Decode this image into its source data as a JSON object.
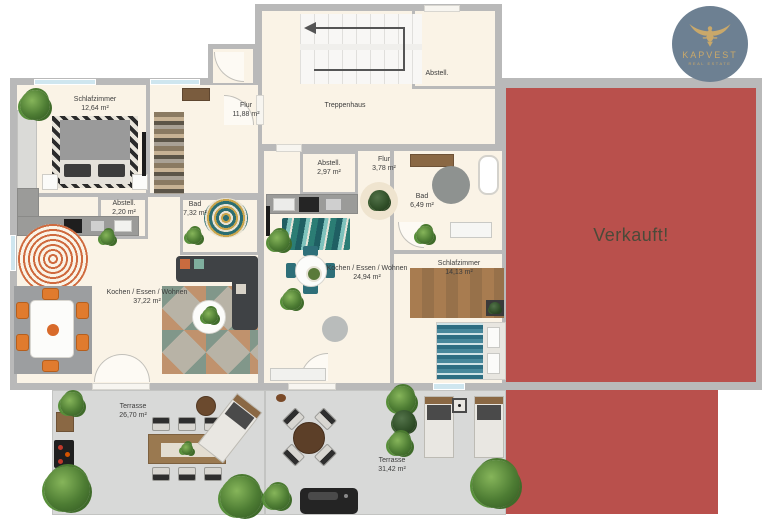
{
  "logo": {
    "brand": "KAPVEST",
    "tagline": "REAL ESTATE"
  },
  "sold": {
    "label": "Verkauft!"
  },
  "shared": {
    "treppenhaus_label": "Treppenhaus",
    "stair_storage": {
      "name": "Abstell."
    }
  },
  "apartments": {
    "left": {
      "rooms": {
        "schlafzimmer": {
          "name": "Schlafzimmer",
          "area": "12,64 m²"
        },
        "flur": {
          "name": "Flur",
          "area": "11,88 m²"
        },
        "abstell": {
          "name": "Abstell.",
          "area": "2,20 m²"
        },
        "bad": {
          "name": "Bad",
          "area": "7,32 m²"
        },
        "wohnen": {
          "name": "Kochen / Essen / Wohnen",
          "area": "37,22 m²"
        },
        "terrasse": {
          "name": "Terrasse",
          "area": "26,70 m²"
        }
      }
    },
    "middle": {
      "rooms": {
        "abstell": {
          "name": "Abstell.",
          "area": "2,97 m²"
        },
        "flur": {
          "name": "Flur",
          "area": "3,78 m²"
        },
        "bad": {
          "name": "Bad",
          "area": "6,49 m²"
        },
        "wohnen": {
          "name": "Kochen / Essen / Wohnen",
          "area": "24,94 m²"
        },
        "schlafzimmer": {
          "name": "Schlafzimmer",
          "area": "14,13 m²"
        },
        "terrasse": {
          "name": "Terrasse",
          "area": "31,42 m²"
        }
      }
    }
  },
  "colors": {
    "sold_fill": "#b9504c",
    "sold_text": "#4b4a39",
    "wall": "#b9b9b9",
    "floor": "#faf3e6",
    "terrace": "#d8d9d8",
    "window": "#cfe6ef",
    "logo_circle": "#6d8092",
    "logo_gold": "#c9a86a"
  }
}
